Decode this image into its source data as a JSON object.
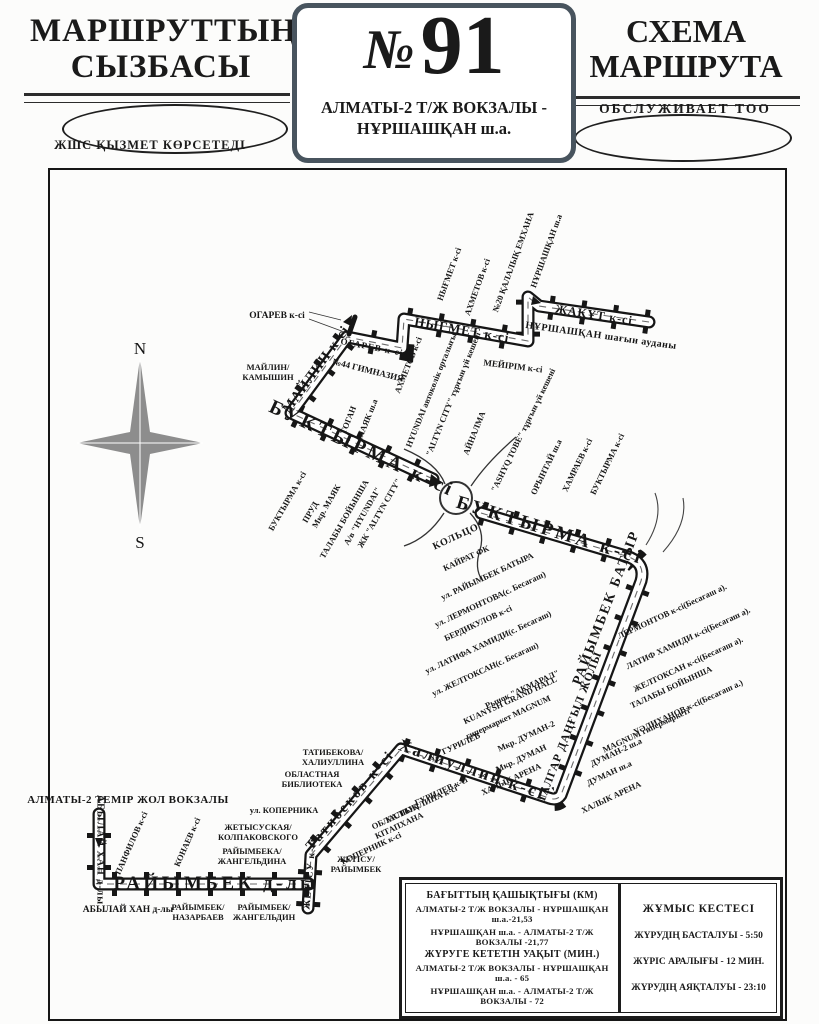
{
  "header": {
    "left_title_1": "МАРШРУТТЫҢ",
    "left_title_2": "СЫЗБАСЫ",
    "left_subtitle": "ЖШС  ҚЫЗМЕТ КӨРСЕТЕДІ",
    "route_number_sign": "№",
    "route_number": "91",
    "route_name_line1": "АЛМАТЫ-2 Т/Ж ВОКЗАЛЫ -",
    "route_name_line2": "НҰРШАШҚАН ш.а.",
    "right_title_1": "СХЕМА",
    "right_title_2": "МАРШРУТА",
    "right_subtitle": "ОБСЛУЖИВАЕТ  ТОО"
  },
  "info_box": {
    "distance_title": "БАҒЫТТЫҢ ҚАШЫҚТЫҒЫ (КМ)",
    "distance_rows": [
      "АЛМАТЫ-2 Т/Ж ВОКЗАЛЫ - НҰРШАШҚАН ш.а.-21,53",
      "НҰРШАШҚАН ш.а. - АЛМАТЫ-2 Т/Ж ВОКЗАЛЫ -21,77"
    ],
    "time_title": "ЖҮРУГЕ КЕТЕТІН УАҚЫТ (МИН.)",
    "time_rows": [
      "АЛМАТЫ-2 Т/Ж ВОКЗАЛЫ - НҰРШАШҚАН ш.а. - 65",
      "НҰРШАШҚАН ш.а. - АЛМАТЫ-2 Т/Ж ВОКЗАЛЫ - 72"
    ],
    "schedule_title": "ЖҰМЫС КЕСТЕСІ",
    "schedule_rows": [
      "ЖҮРУДІҢ БАСТАЛУЫ - 5:50",
      "ЖҮРІС АРАЛЫҒЫ - 12 МИН.",
      "ЖҮРУДІҢ АЯҚТАЛУЫ - 23:10"
    ]
  },
  "map_labels": [
    {
      "t": "N",
      "x": 140,
      "y": 349,
      "r": 0,
      "c": "compass-lbl"
    },
    {
      "t": "S",
      "x": 140,
      "y": 543,
      "r": 0,
      "c": "compass-lbl"
    },
    {
      "t": "ЖАҚҰТ к-сі",
      "x": 594,
      "y": 315,
      "r": 9,
      "c": "rt",
      "fs": 12
    },
    {
      "t": "НҰРШАШҚАН шағын ауданы",
      "x": 601,
      "y": 336,
      "r": 8,
      "c": "pl",
      "fs": 10
    },
    {
      "t": "НЫҒМЕТ к-сі",
      "x": 462,
      "y": 330,
      "r": 10,
      "c": "rt",
      "fs": 13
    },
    {
      "t": "ОГАРЕВ к-сі",
      "x": 372,
      "y": 347,
      "r": 11,
      "c": "rt",
      "fs": 9
    },
    {
      "t": "МАЙЛИН к-сі",
      "x": 317,
      "y": 370,
      "r": -54,
      "c": "rt",
      "fs": 14
    },
    {
      "t": "БУКТЫРМА к-сі",
      "x": 362,
      "y": 449,
      "r": 25,
      "c": "rt-lg"
    },
    {
      "t": "БУКТЫРМА к-сі",
      "x": 550,
      "y": 531,
      "r": 17,
      "c": "rt-lg",
      "fs": 19
    },
    {
      "t": "РАЙЫМБЕК БАТЫР",
      "x": 607,
      "y": 608,
      "r": -69,
      "c": "rt",
      "fs": 14,
      "ls": 2
    },
    {
      "t": "ТАЛГАР ДАҢҒЫЛ ЖОЛЫ",
      "x": 570,
      "y": 727,
      "r": -69,
      "c": "rt",
      "fs": 11.5
    },
    {
      "t": "Халиуллин к-сі",
      "x": 472,
      "y": 770,
      "r": 19,
      "c": "rt-serif"
    },
    {
      "t": "Татибеков к-сі",
      "x": 351,
      "y": 801,
      "r": -49,
      "c": "rt-serif",
      "fs": 14
    },
    {
      "t": "ЖЕТІСУ к-сі",
      "x": 310,
      "y": 874,
      "r": -85,
      "c": "rt",
      "fs": 10
    },
    {
      "t": "РАЙЫМБЕК д-лы",
      "x": 216,
      "y": 884,
      "r": 0,
      "c": "rt-lg",
      "fs": 19
    },
    {
      "t": "АБЫЛАЙ ХАН д-лы",
      "x": 100,
      "y": 850,
      "r": 90,
      "c": "rt",
      "fs": 10
    },
    {
      "t": "АЛМАТЫ-2 ТЕМІР ЖОЛ ВОКЗАЛЫ",
      "x": 128,
      "y": 800,
      "r": 0,
      "c": "pl",
      "fs": 11
    },
    {
      "t": "НЫҒМЕТ к-сі",
      "x": 449,
      "y": 274,
      "r": -70,
      "c": "co"
    },
    {
      "t": "АХМЕТОВ к-сі",
      "x": 477,
      "y": 287,
      "r": -70,
      "c": "co"
    },
    {
      "t": "№20 ҚАЛАЛЫҚ ЕМХАНА",
      "x": 513,
      "y": 262,
      "r": -70,
      "c": "co"
    },
    {
      "t": "НҰРШАШҚАН ш.а",
      "x": 546,
      "y": 251,
      "r": -70,
      "c": "co"
    },
    {
      "t": "МЕЙІРІМ к-сі",
      "x": 513,
      "y": 366,
      "r": 7,
      "c": "co",
      "fs": 9
    },
    {
      "t": "ОГАРЕВ к-сі",
      "x": 277,
      "y": 316,
      "r": 0,
      "c": "co",
      "fs": 9.5
    },
    {
      "t": "МАЙЛИН/\nКАМЫШИН",
      "x": 268,
      "y": 372,
      "r": 0,
      "c": "co2"
    },
    {
      "t": "№44 ГИМНАЗИЯ",
      "x": 368,
      "y": 370,
      "r": 14,
      "c": "co",
      "fs": 9
    },
    {
      "t": "АХМЕТОВ к-сі",
      "x": 408,
      "y": 365,
      "r": -68,
      "c": "co"
    },
    {
      "t": "HYUNDAI автокөлік орталығы",
      "x": 431,
      "y": 390,
      "r": -68,
      "c": "co"
    },
    {
      "t": "\"ALTYN CITY\" тұрғын үй кешені",
      "x": 453,
      "y": 394,
      "r": -68,
      "c": "co"
    },
    {
      "t": "АЙНАЛМА",
      "x": 474,
      "y": 433,
      "r": -68,
      "c": "co"
    },
    {
      "t": "ТОГАН",
      "x": 348,
      "y": 420,
      "r": -68,
      "c": "co"
    },
    {
      "t": "МАЯК ш.а",
      "x": 367,
      "y": 419,
      "r": -68,
      "c": "co"
    },
    {
      "t": "БУКТЫРМА к-сі",
      "x": 287,
      "y": 501,
      "r": -60,
      "c": "co"
    },
    {
      "t": "ПРУД",
      "x": 310,
      "y": 512,
      "r": -60,
      "c": "co"
    },
    {
      "t": "Мкр. МАЯК",
      "x": 326,
      "y": 506,
      "r": -60,
      "c": "co"
    },
    {
      "t": "ТАЛАБЫ БОЙЫНША",
      "x": 344,
      "y": 519,
      "r": -60,
      "c": "co"
    },
    {
      "t": "А/в \"HYUNDAI\"",
      "x": 362,
      "y": 516,
      "r": -60,
      "c": "co"
    },
    {
      "t": "ЖК \"ALTYN CITY\"",
      "x": 379,
      "y": 513,
      "r": -60,
      "c": "co"
    },
    {
      "t": "КОЛЬЦО",
      "x": 456,
      "y": 537,
      "r": -25,
      "c": "co-b"
    },
    {
      "t": "КАЙРАТ ФК",
      "x": 466,
      "y": 558,
      "r": -25,
      "c": "co"
    },
    {
      "t": "\"ASHYQ TOBE\" тұрғын үй кешені",
      "x": 523,
      "y": 430,
      "r": -64,
      "c": "co"
    },
    {
      "t": "ОРЫНТАЙ ш.а",
      "x": 546,
      "y": 467,
      "r": -64,
      "c": "co"
    },
    {
      "t": "ХАМРАЕВ к-сі",
      "x": 577,
      "y": 465,
      "r": -64,
      "c": "co"
    },
    {
      "t": "БУКТЫРМА к-сі",
      "x": 607,
      "y": 464,
      "r": -64,
      "c": "co"
    },
    {
      "t": "ул. РАЙЫМБЕК БАТЫРА",
      "x": 487,
      "y": 576,
      "r": -25,
      "c": "co"
    },
    {
      "t": "ул. ЛЕРМОНТОВА(с. Бесагаш)",
      "x": 490,
      "y": 599,
      "r": -25,
      "c": "co"
    },
    {
      "t": "БЕРДИКУЛОВ к-сі",
      "x": 478,
      "y": 623,
      "r": -25,
      "c": "co"
    },
    {
      "t": "ул. ЛАТИФА ХАМИДИ(с. Бесагаш)",
      "x": 488,
      "y": 642,
      "r": -25,
      "c": "co"
    },
    {
      "t": "ул. ЖЕЛТОКСАН(с. Бесагаш)",
      "x": 485,
      "y": 669,
      "r": -25,
      "c": "co"
    },
    {
      "t": "Рынок \"АКМАРАЛ\"",
      "x": 522,
      "y": 689,
      "r": -25,
      "c": "co"
    },
    {
      "t": "KUANYSH GRAND HALL",
      "x": 510,
      "y": 700,
      "r": -25,
      "c": "co"
    },
    {
      "t": "гипермаркет MAGNUM",
      "x": 508,
      "y": 717,
      "r": -25,
      "c": "co"
    },
    {
      "t": "Мкр. ДУМАН-2",
      "x": 526,
      "y": 736,
      "r": -25,
      "c": "co"
    },
    {
      "t": "Мкр. ДУМАН",
      "x": 521,
      "y": 758,
      "r": -25,
      "c": "co"
    },
    {
      "t": "ХАЛЫК АРЕНА",
      "x": 511,
      "y": 779,
      "r": -25,
      "c": "co"
    },
    {
      "t": "ул. ГУРИЛЕВ",
      "x": 455,
      "y": 746,
      "r": -25,
      "c": "co"
    },
    {
      "t": "ЛЕРМОНТОВ к-сі(Бесагаш а).",
      "x": 672,
      "y": 611,
      "r": -25,
      "c": "co"
    },
    {
      "t": "ЛАТИФ ХАМИДИ к-сі(Бесагаш а).",
      "x": 688,
      "y": 638,
      "r": -25,
      "c": "co"
    },
    {
      "t": "ЖЕЛТОКСАН к-сі(Бесагаш а).",
      "x": 688,
      "y": 664,
      "r": -25,
      "c": "co"
    },
    {
      "t": "ТАЛАБЫ БОЙЫНША",
      "x": 671,
      "y": 687,
      "r": -25,
      "c": "co"
    },
    {
      "t": "УӘЛИХАНОВ к-сі(Бесагаш а.)",
      "x": 688,
      "y": 707,
      "r": -25,
      "c": "co"
    },
    {
      "t": "MAGNUM гипермаркеті",
      "x": 646,
      "y": 730,
      "r": -25,
      "c": "co"
    },
    {
      "t": "ДУМАН-2 ш.а",
      "x": 616,
      "y": 752,
      "r": -25,
      "c": "co"
    },
    {
      "t": "ДУМАН ш.а",
      "x": 609,
      "y": 773,
      "r": -25,
      "c": "co"
    },
    {
      "t": "ХАЛЫК АРЕНА",
      "x": 611,
      "y": 797,
      "r": -25,
      "c": "co"
    },
    {
      "t": "ГУРИЛЕВ к-сі",
      "x": 441,
      "y": 791,
      "r": -25,
      "c": "co"
    },
    {
      "t": "ХАЛИУЛЛИНА к-сі",
      "x": 421,
      "y": 804,
      "r": -25,
      "c": "co"
    },
    {
      "t": "ОБЛАСТЫҚ\nКІТАПХАНА",
      "x": 397,
      "y": 821,
      "r": -25,
      "c": "co2"
    },
    {
      "t": "КОПЕРНИК к-сі",
      "x": 371,
      "y": 848,
      "r": -25,
      "c": "co"
    },
    {
      "t": "ЖЕТІСУ/\nРАЙЫМБЕК",
      "x": 356,
      "y": 864,
      "r": 0,
      "c": "co2"
    },
    {
      "t": "ТАТИБЕКОВА/\nХАЛИУЛЛИНА",
      "x": 333,
      "y": 757,
      "r": 0,
      "c": "co2"
    },
    {
      "t": "ОБЛАСТНАЯ\nБИБЛИОТЕКА",
      "x": 312,
      "y": 779,
      "r": 0,
      "c": "co2"
    },
    {
      "t": "ул. КОПЕРНИКА",
      "x": 284,
      "y": 810,
      "r": 0,
      "c": "co"
    },
    {
      "t": "ЖЕТЫСУСКАЯ/\nКОЛПАКОВСКОГО",
      "x": 258,
      "y": 832,
      "r": 0,
      "c": "co2"
    },
    {
      "t": "РАЙЫМБЕКА/\nЖАНГЕЛЬДИНА",
      "x": 252,
      "y": 856,
      "r": 0,
      "c": "co2"
    },
    {
      "t": "ПАНФИЛОВ к-сі",
      "x": 131,
      "y": 843,
      "r": -66,
      "c": "co"
    },
    {
      "t": "КОНАЕВ к-сі",
      "x": 187,
      "y": 842,
      "r": -66,
      "c": "co"
    },
    {
      "t": "АБЫЛАЙ ХАН д-лы",
      "x": 128,
      "y": 910,
      "r": 0,
      "c": "co",
      "fs": 9.5
    },
    {
      "t": "РАЙЫМБЕК/\nНАЗАРБАЕВ",
      "x": 198,
      "y": 912,
      "r": 0,
      "c": "co2"
    },
    {
      "t": "РАЙЫМБЕК/\nЖАНГЕЛЬДИН",
      "x": 264,
      "y": 912,
      "r": 0,
      "c": "co2"
    }
  ]
}
